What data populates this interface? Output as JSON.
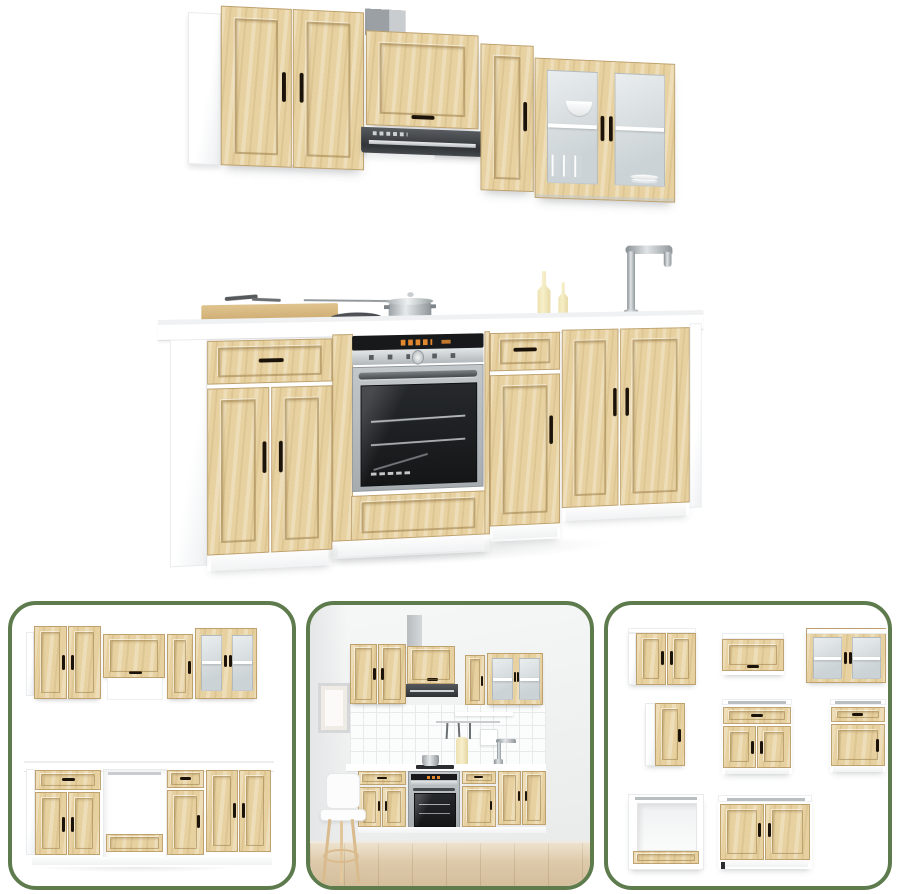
{
  "colors": {
    "wood": "#e7d1a0",
    "wood_hi": "#eedcb0",
    "wood_lo": "#d9bd87",
    "handle": "#1b1309",
    "hood": "#3c4044",
    "steel_hi": "#e2e5e6",
    "steel_lo": "#8e969a",
    "oven_glass": "#1b1d1f",
    "oven_accent": "#e1882f",
    "glass_hi": "#e9edee",
    "glass_lo": "#ccd3d6",
    "green": "#5d7b4c",
    "shade": "#e8eaec",
    "floor_hi": "#e4d3b5",
    "floor_lo": "#d3bd9a"
  },
  "main_image": {
    "label": "Kitchen cabinet set in light oak: wall cabinets with glass display unit and extractor hood above a base run with built-in oven, hob, sink and tap"
  },
  "thumbnails": [
    {
      "label": "Full cabinet set, front view without appliances"
    },
    {
      "label": "Kitchen cabinet set shown installed in a room"
    },
    {
      "label": "All eight cabinet units shown individually"
    }
  ]
}
